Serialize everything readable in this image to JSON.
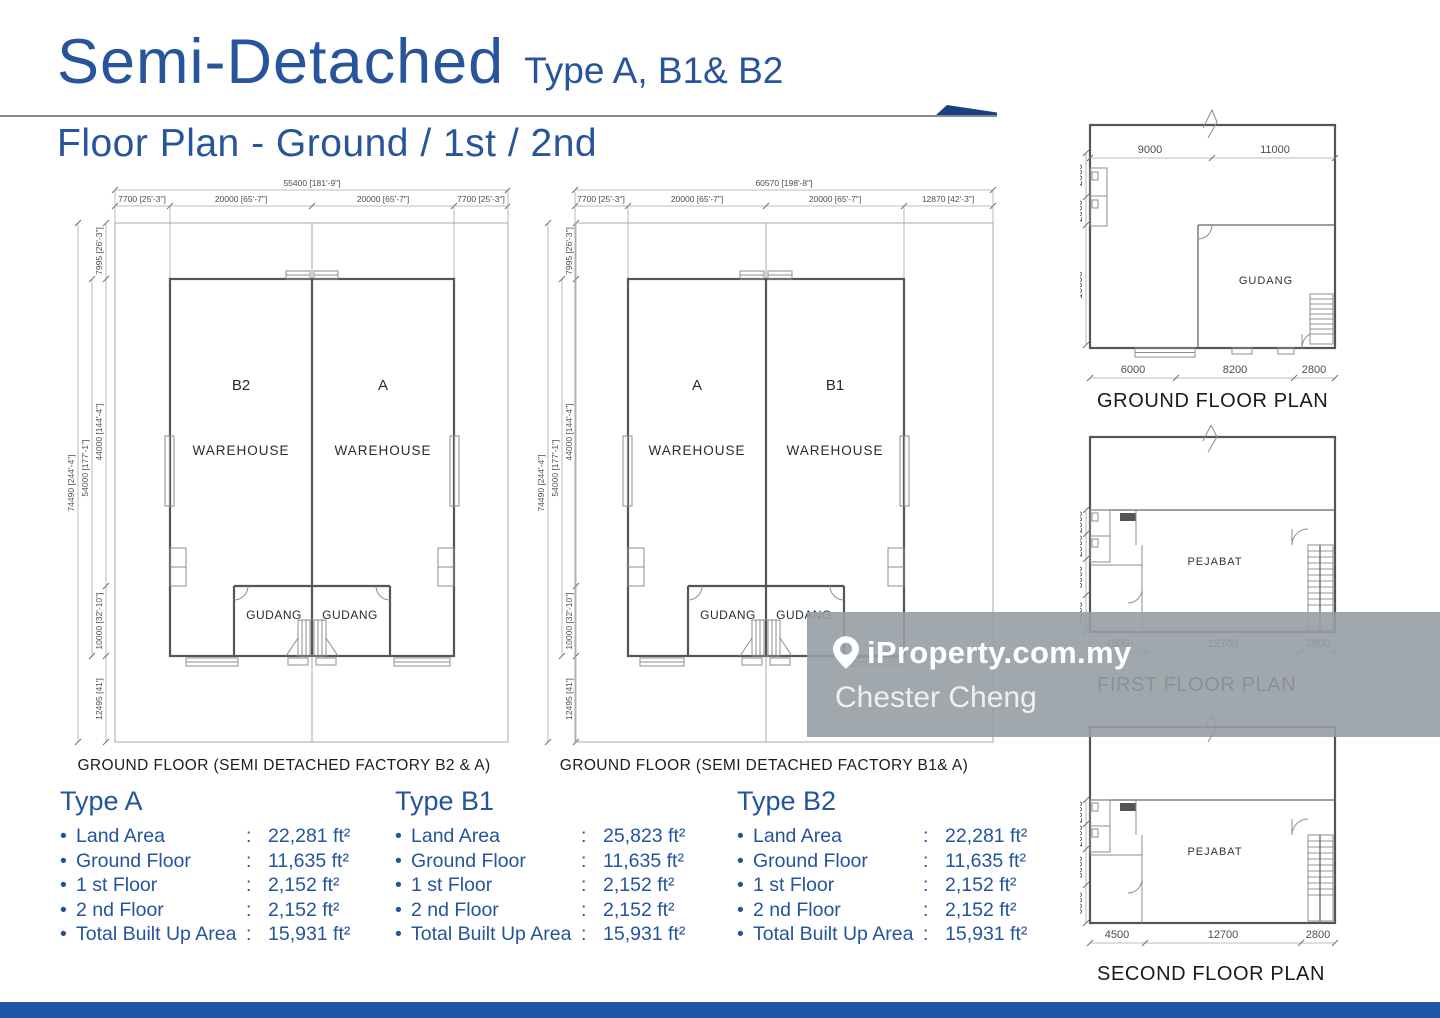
{
  "header": {
    "title": "Semi-Detached",
    "title_suffix": "Type A, B1& B2",
    "subtitle": "Floor Plan - Ground / 1st / 2nd"
  },
  "plan_b2a": {
    "caption": "GROUND FLOOR (SEMI DETACHED FACTORY B2 & A)",
    "unit_left": "B2",
    "unit_right": "A",
    "room_left": "WAREHOUSE",
    "room_right": "WAREHOUSE",
    "gudang_left": "GUDANG",
    "gudang_right": "GUDANG",
    "dim_total_top": "55400 [181'-9\"]",
    "dim_top": [
      "7700 [25'-3\"]",
      "20000 [65'-7\"]",
      "20000 [65'-7\"]",
      "7700 [25'-3\"]"
    ],
    "dim_left_outer": "74490 [244'-4\"]",
    "dim_left_mid": "54000 [177'-1\"]",
    "dim_left_inner": [
      "7995 [26'-3\"]",
      "44000 [144'-4\"]",
      "10000 [32'-10\"]",
      "12495 [41']"
    ]
  },
  "plan_b1a": {
    "caption": "GROUND FLOOR (SEMI DETACHED FACTORY B1& A)",
    "unit_left": "A",
    "unit_right": "B1",
    "room_left": "WAREHOUSE",
    "room_right": "WAREHOUSE",
    "gudang_left": "GUDANG",
    "gudang_right": "GUDANG",
    "dim_total_top": "60570 [198'-8\"]",
    "dim_top": [
      "7700 [25'-3\"]",
      "20000 [65'-7\"]",
      "20000 [65'-7\"]",
      "12870 [42'-3\"]"
    ],
    "dim_left_outer": "74490 [244'-4\"]",
    "dim_left_mid": "54000 [177'-1\"]",
    "dim_left_inner": [
      "7995 [26'-3\"]",
      "44000 [144'-4\"]",
      "10000 [32'-10\"]",
      "12495 [41']"
    ]
  },
  "plan_ground": {
    "caption": "GROUND FLOOR PLAN",
    "room": "GUDANG",
    "dim_top": [
      "9000",
      "11000"
    ],
    "dim_left": [
      "2600",
      "2000",
      "10050"
    ],
    "dim_bottom": [
      "6000",
      "8200",
      "2800"
    ]
  },
  "plan_first": {
    "caption": "FIRST FLOOR PLAN",
    "room": "PEJABAT",
    "dim_left": [
      "2000",
      "2000",
      "3000",
      "3000"
    ],
    "dim_bottom": [
      "4500",
      "12700",
      "2800"
    ]
  },
  "plan_second": {
    "caption": "SECOND FLOOR PLAN",
    "room": "PEJABAT",
    "dim_left": [
      "2000",
      "2000",
      "3000",
      "3000"
    ],
    "dim_bottom": [
      "4500",
      "12700",
      "2800"
    ]
  },
  "specs": {
    "bullet": "•",
    "colon": ":",
    "columns": [
      {
        "title": "Type A",
        "rows": [
          {
            "label": "Land Area",
            "value": "22,281 ft²"
          },
          {
            "label": "Ground Floor",
            "value": "11,635 ft²"
          },
          {
            "label": "1 st Floor",
            "value": "2,152 ft²"
          },
          {
            "label": "2 nd Floor",
            "value": "2,152 ft²"
          },
          {
            "label": "Total Built Up Area",
            "value": "15,931 ft²"
          }
        ]
      },
      {
        "title": "Type B1",
        "rows": [
          {
            "label": "Land Area",
            "value": "25,823 ft²"
          },
          {
            "label": "Ground Floor",
            "value": "11,635 ft²"
          },
          {
            "label": "1 st Floor",
            "value": "2,152 ft²"
          },
          {
            "label": "2 nd Floor",
            "value": "2,152 ft²"
          },
          {
            "label": "Total Built Up Area",
            "value": "15,931 ft²"
          }
        ]
      },
      {
        "title": "Type B2",
        "rows": [
          {
            "label": "Land Area",
            "value": "22,281 ft²"
          },
          {
            "label": "Ground Floor",
            "value": "11,635 ft²"
          },
          {
            "label": "1 st Floor",
            "value": "2,152 ft²"
          },
          {
            "label": "2 nd Floor",
            "value": "2,152 ft²"
          },
          {
            "label": "Total Built Up Area",
            "value": "15,931 ft²"
          }
        ]
      }
    ]
  },
  "watermark": {
    "brand": "iProperty.com.my",
    "agent": "Chester Cheng"
  },
  "colors": {
    "accent_blue": "#27549B",
    "footer_blue": "#1D55A8",
    "swoosh_blue": "#17417F",
    "watermark_gray": "#97A0A6"
  }
}
